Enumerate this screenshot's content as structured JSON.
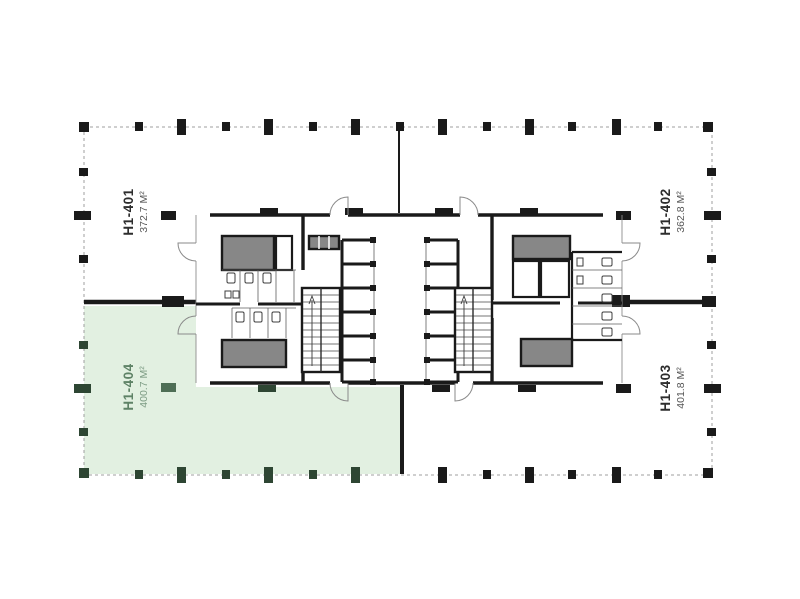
{
  "floor_plan": {
    "highlighted_unit": "H1-404",
    "units": [
      {
        "id": "H1-401",
        "label": "H1-401",
        "area": "372.7 М²",
        "position": "top-left",
        "highlighted": false
      },
      {
        "id": "H1-402",
        "label": "H1-402",
        "area": "362.8 М²",
        "position": "top-right",
        "highlighted": false
      },
      {
        "id": "H1-403",
        "label": "H1-403",
        "area": "401.8 М²",
        "position": "bottom-right",
        "highlighted": false
      },
      {
        "id": "H1-404",
        "label": "H1-404",
        "area": "400.7 М²",
        "position": "bottom-left",
        "highlighted": true
      }
    ]
  },
  "colors": {
    "wall": "#1a1a1a",
    "gray": "#878787",
    "dash": "#9f9f9f",
    "green-fill": "#e2f0e1",
    "green-dark": "#2e4633",
    "green-col": "#4e6e55",
    "green-text": "#5e8266",
    "green-text2": "#7d9c84",
    "ink": "#2d2d2d",
    "ink2": "#575757",
    "bg": "#ffffff"
  }
}
